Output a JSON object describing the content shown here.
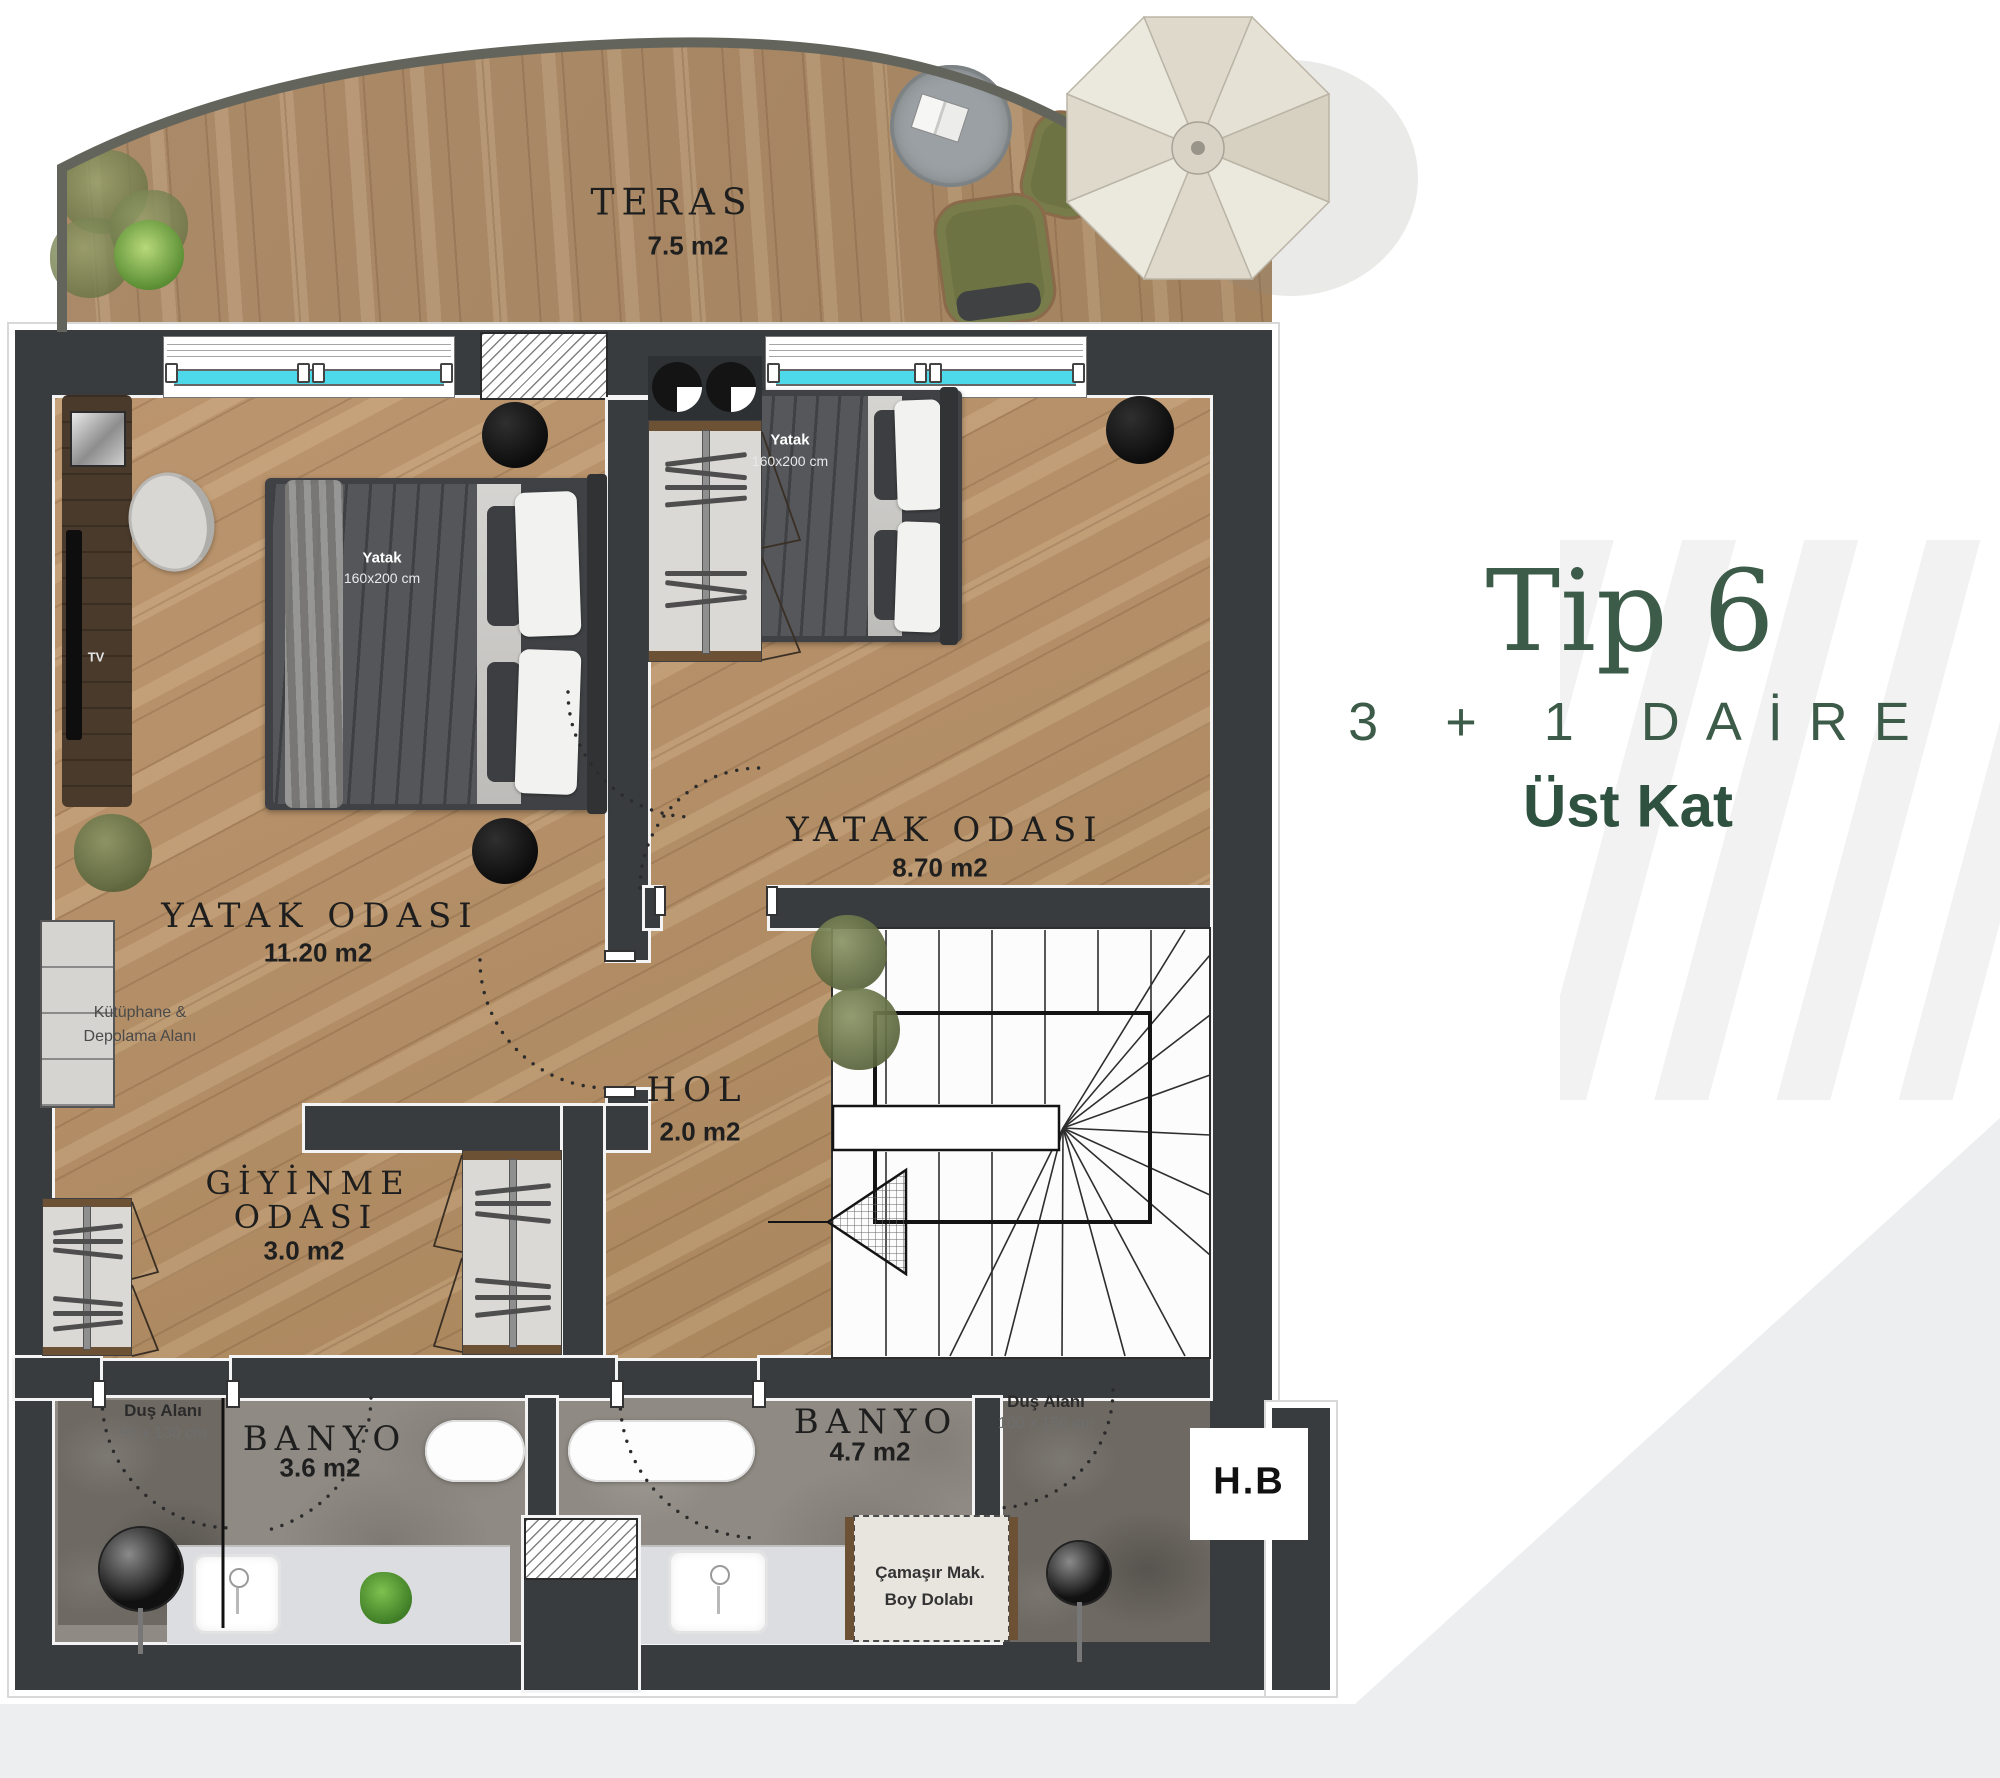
{
  "title": {
    "name": "Tip 6",
    "subtitle": "3 + 1 DAİRE",
    "floor": "Üst Kat"
  },
  "rooms": {
    "teras": {
      "name": "TERAS",
      "area": "7.5 m2"
    },
    "bedroom_left": {
      "name": "YATAK ODASI",
      "area": "11.20 m2"
    },
    "bedroom_right": {
      "name": "YATAK ODASI",
      "area": "8.70 m2"
    },
    "hol": {
      "name": "HOL",
      "area": "2.0 m2"
    },
    "dressing": {
      "name_line1": "GİYİNME",
      "name_line2": "ODASI",
      "area": "3.0 m2"
    },
    "bath_left": {
      "name": "BANYO",
      "area": "3.6 m2"
    },
    "bath_right": {
      "name": "BANYO",
      "area": "4.7 m2"
    }
  },
  "annotations": {
    "bed": {
      "line1": "Yatak",
      "line2": "160x200 cm"
    },
    "shower_left": {
      "line1": "Duş Alanı",
      "line2": "90 x 130 cm"
    },
    "shower_right": {
      "line1": "Duş Alanı",
      "line2": "100 x 150 cm"
    },
    "library": {
      "line1": "Kütüphane &",
      "line2": "Depolama Alanı"
    },
    "laundry": {
      "line1": "Çamaşır Mak.",
      "line2": "Boy Dolabı"
    },
    "tv": "TV",
    "hb": "H.B"
  },
  "colors": {
    "accent_green": "#3c5b48",
    "floor_label_green": "#2f5140",
    "wall": "#393c3f",
    "window_glass": "#4ed9ea",
    "wood_floor": "#b99168",
    "terrace_wood": "#ab8a64",
    "bath_tile": "#8f8a83",
    "background_wedge": "#eceef0"
  },
  "icons": {
    "umbrella-icon": "octagon parasol shape",
    "plant-icon": "organic green circle",
    "rug-icon": "gray circle with book",
    "stair-arrow-icon": "hatched triangle pointing left",
    "shower-head-icon": "dark circle with stem",
    "wardrobe-hanger-icon": "horizontal bars on pole"
  }
}
